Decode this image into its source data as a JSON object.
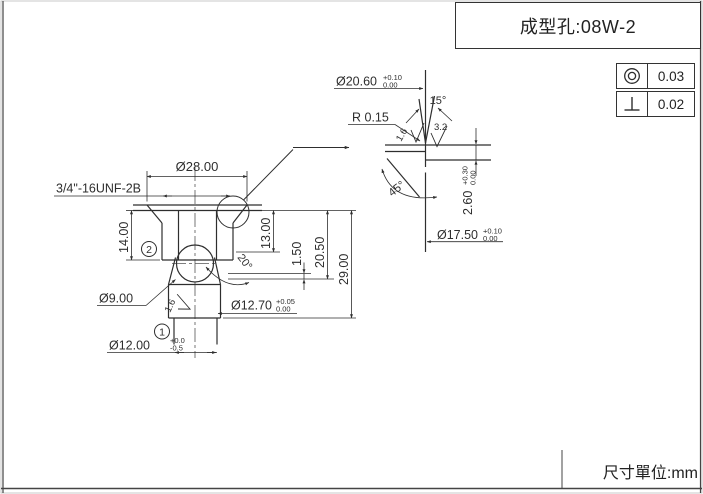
{
  "title_block": {
    "title": "成型孔:08W-2"
  },
  "page": {
    "unit_note": "尺寸單位:mm"
  },
  "gdt": [
    {
      "symbol": "concentricity",
      "value": "0.03"
    },
    {
      "symbol": "perpendicularity",
      "value": "0.02"
    }
  ],
  "main_view": {
    "thread_callout": "3/4\"-16UNF-2B",
    "dia28": "Ø28.00",
    "depth14": "14.00",
    "depth13": "13.00",
    "depth1_50": "1.50",
    "depth20_50": "20.50",
    "depth29": "29.00",
    "dia9": "Ø9.00",
    "angle20": "20°",
    "dia12_70": {
      "nominal": "Ø12.70",
      "upper": "+0.05",
      "lower": "0.00"
    },
    "dia12_00": {
      "nominal": "Ø12.00",
      "upper": "+0.0",
      "lower": "-0.5"
    },
    "balloon_1": "1",
    "balloon_2": "2",
    "roughness_1_6": "1.6"
  },
  "detail_view": {
    "dia20_60": {
      "nominal": "Ø20.60",
      "upper": "+0.10",
      "lower": "0.00"
    },
    "radius": "R 0.15",
    "angle15": "15°",
    "angle45": "45°",
    "depth2_60": {
      "nominal": "2.60",
      "upper": "+0.30",
      "lower": "0.00"
    },
    "dia17_50": {
      "nominal": "Ø17.50",
      "upper": "+0.10",
      "lower": "0.00"
    },
    "roughness_1_6": "1.6",
    "roughness_3_2": "3.2"
  }
}
